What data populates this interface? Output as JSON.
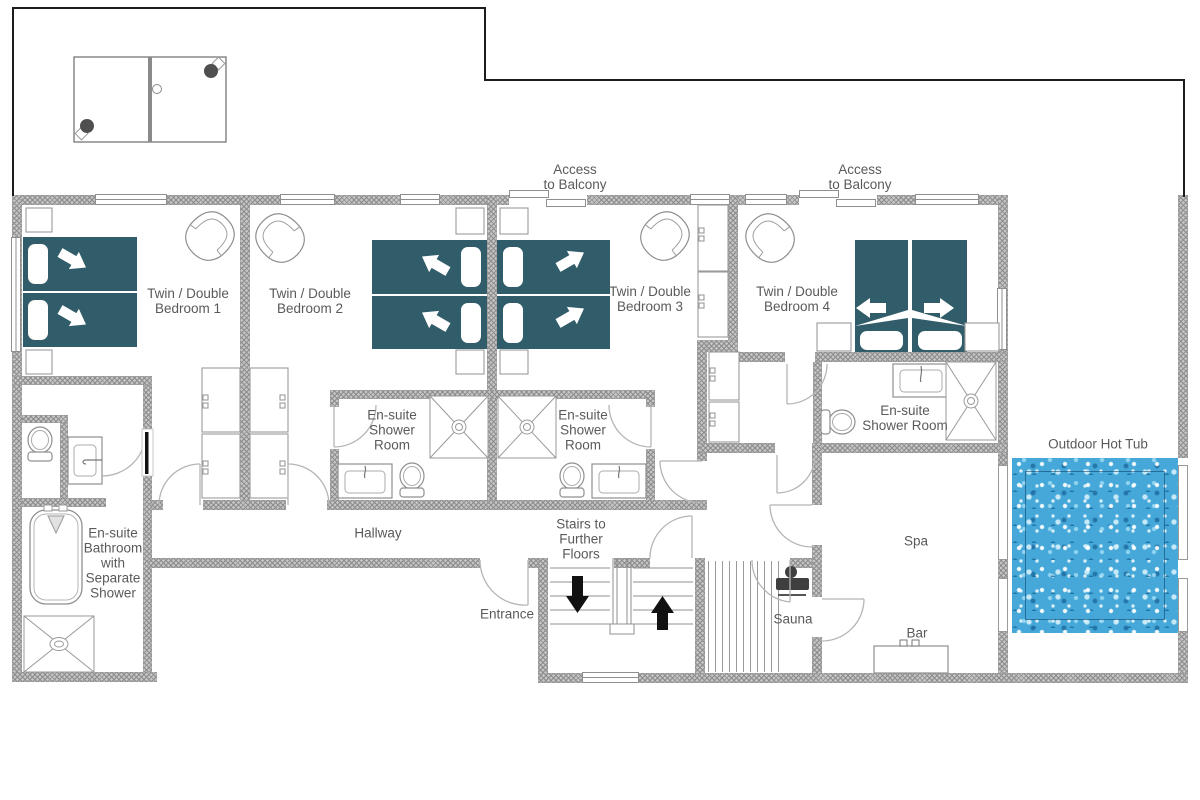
{
  "colors": {
    "bed": "#315d6a",
    "water": "#45a8d8",
    "wall": "#c4c4c4",
    "hatch": "#8d8d8d",
    "text": "#5a5a5a",
    "stair_arrow": "#111111",
    "sauna_heater": "#3f3f3f"
  },
  "labels": {
    "access_balcony_left": {
      "line1": "Access",
      "line2": "to Balcony"
    },
    "access_balcony_right": {
      "line1": "Access",
      "line2": "to Balcony"
    },
    "bedroom1": {
      "line1": "Twin / Double",
      "line2": "Bedroom 1"
    },
    "bedroom2": {
      "line1": "Twin / Double",
      "line2": "Bedroom 2"
    },
    "bedroom3": {
      "line1": "Twin / Double",
      "line2": "Bedroom 3"
    },
    "bedroom4": {
      "line1": "Twin / Double",
      "line2": "Bedroom 4"
    },
    "ensuite2": {
      "line1": "En-suite",
      "line2": "Shower",
      "line3": "Room"
    },
    "ensuite3": {
      "line1": "En-suite",
      "line2": "Shower",
      "line3": "Room"
    },
    "ensuite4": {
      "line1": "En-suite",
      "line2": "Shower Room"
    },
    "bathroom": {
      "line1": "En-suite",
      "line2": "Bathroom",
      "line3": "with",
      "line4": "Separate",
      "line5": "Shower"
    },
    "hallway": "Hallway",
    "stairs": {
      "line1": "Stairs to",
      "line2": "Further",
      "line3": "Floors"
    },
    "entrance": "Entrance",
    "sauna": "Sauna",
    "spa": "Spa",
    "bar": "Bar",
    "hot_tub": "Outdoor Hot Tub"
  }
}
